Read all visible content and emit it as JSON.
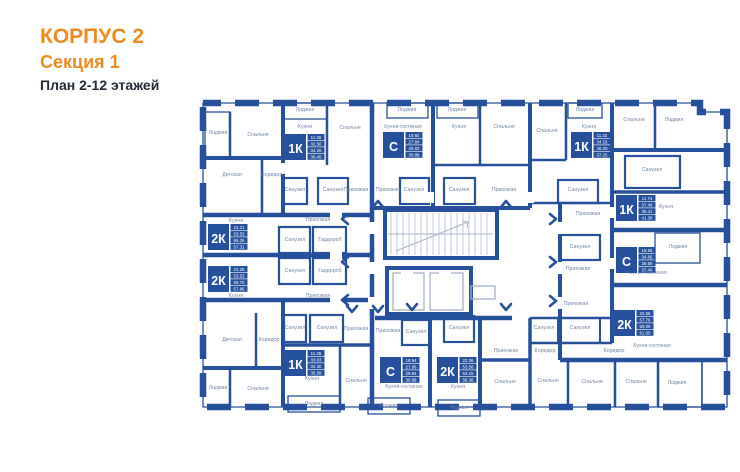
{
  "header": {
    "building": "КОРПУС 2",
    "section": "Секция 1",
    "floors": "План 2-12 этажей"
  },
  "colors": {
    "accent": "#ee8b1e",
    "wall": "#25519c",
    "room_label": "#7487a8",
    "title_dark": "#222b38",
    "stair_line": "#a7b4cd"
  },
  "plan": {
    "rooms": [
      {
        "label": "Лоджия",
        "x": 218,
        "y": 134
      },
      {
        "label": "Спальня",
        "x": 258,
        "y": 136
      },
      {
        "label": "Лоджия",
        "x": 305,
        "y": 111
      },
      {
        "label": "Кухня",
        "x": 305,
        "y": 128
      },
      {
        "label": "Спальня",
        "x": 350,
        "y": 129
      },
      {
        "label": "Лоджия",
        "x": 407,
        "y": 111
      },
      {
        "label": "Кухня-гостиная",
        "x": 403,
        "y": 128
      },
      {
        "label": "Лоджия",
        "x": 457,
        "y": 111
      },
      {
        "label": "Кухня",
        "x": 459,
        "y": 128
      },
      {
        "label": "Спальня",
        "x": 504,
        "y": 128
      },
      {
        "label": "Спальня",
        "x": 547,
        "y": 132
      },
      {
        "label": "Лоджия",
        "x": 585,
        "y": 111
      },
      {
        "label": "Кухня",
        "x": 589,
        "y": 128
      },
      {
        "label": "Спальня",
        "x": 634,
        "y": 121
      },
      {
        "label": "Лоджия",
        "x": 674,
        "y": 121
      },
      {
        "label": "Детская",
        "x": 232,
        "y": 176
      },
      {
        "label": "Коридор",
        "x": 272,
        "y": 176
      },
      {
        "label": "Санузел",
        "x": 295,
        "y": 191
      },
      {
        "label": "Санузел",
        "x": 333,
        "y": 191
      },
      {
        "label": "Прихожая",
        "x": 356,
        "y": 191
      },
      {
        "label": "Прихожая",
        "x": 388,
        "y": 191
      },
      {
        "label": "Санузел",
        "x": 414,
        "y": 191
      },
      {
        "label": "Санузел",
        "x": 459,
        "y": 191
      },
      {
        "label": "Прихожая",
        "x": 504,
        "y": 191
      },
      {
        "label": "Санузел",
        "x": 578,
        "y": 191
      },
      {
        "label": "Санузел",
        "x": 652,
        "y": 171
      },
      {
        "label": "Прихожая",
        "x": 588,
        "y": 215
      },
      {
        "label": "Кухня",
        "x": 666,
        "y": 208
      },
      {
        "label": "Кухня",
        "x": 236,
        "y": 222
      },
      {
        "label": "Прихожая",
        "x": 318,
        "y": 221
      },
      {
        "label": "Санузел",
        "x": 295,
        "y": 241
      },
      {
        "label": "Гардероб",
        "x": 330,
        "y": 241
      },
      {
        "label": "Санузел",
        "x": 295,
        "y": 272
      },
      {
        "label": "Гардероб",
        "x": 330,
        "y": 272
      },
      {
        "label": "Кухня",
        "x": 236,
        "y": 297
      },
      {
        "label": "Прихожая",
        "x": 318,
        "y": 297
      },
      {
        "label": "Санузел",
        "x": 580,
        "y": 248
      },
      {
        "label": "Прихожая",
        "x": 578,
        "y": 270
      },
      {
        "label": "Лоджия",
        "x": 678,
        "y": 248
      },
      {
        "label": "Кухня-гостиная",
        "x": 648,
        "y": 274
      },
      {
        "label": "Прихожая",
        "x": 576,
        "y": 305
      },
      {
        "label": "Санузел",
        "x": 544,
        "y": 329
      },
      {
        "label": "Санузел",
        "x": 580,
        "y": 329
      },
      {
        "label": "Коридор",
        "x": 545,
        "y": 352
      },
      {
        "label": "Коридор",
        "x": 614,
        "y": 352
      },
      {
        "label": "Кухня-гостиная",
        "x": 652,
        "y": 347
      },
      {
        "label": "Детская",
        "x": 232,
        "y": 341
      },
      {
        "label": "Коридор",
        "x": 269,
        "y": 341
      },
      {
        "label": "Санузел",
        "x": 295,
        "y": 329
      },
      {
        "label": "Санузел",
        "x": 327,
        "y": 329
      },
      {
        "label": "Прихожая",
        "x": 356,
        "y": 330
      },
      {
        "label": "Прихожая",
        "x": 388,
        "y": 332
      },
      {
        "label": "Санузел",
        "x": 416,
        "y": 333
      },
      {
        "label": "Санузел",
        "x": 459,
        "y": 329
      },
      {
        "label": "Прихожая",
        "x": 506,
        "y": 352
      },
      {
        "label": "Лоджия",
        "x": 218,
        "y": 389
      },
      {
        "label": "Спальня",
        "x": 258,
        "y": 390
      },
      {
        "label": "Кухня",
        "x": 312,
        "y": 380
      },
      {
        "label": "Спальня",
        "x": 356,
        "y": 382
      },
      {
        "label": "Кухня-гостиная",
        "x": 404,
        "y": 388
      },
      {
        "label": "Кухня",
        "x": 458,
        "y": 388
      },
      {
        "label": "Лоджия",
        "x": 314,
        "y": 405
      },
      {
        "label": "Лоджия",
        "x": 389,
        "y": 407
      },
      {
        "label": "Лоджия",
        "x": 459,
        "y": 409
      },
      {
        "label": "Спальня",
        "x": 505,
        "y": 383
      },
      {
        "label": "Спальня",
        "x": 548,
        "y": 382
      },
      {
        "label": "Спальня",
        "x": 592,
        "y": 383
      },
      {
        "label": "Спальня",
        "x": 636,
        "y": 383
      },
      {
        "label": "Лоджия",
        "x": 677,
        "y": 384
      }
    ],
    "apartments": [
      {
        "type": "1К",
        "areas": [
          "11.36",
          "32.50",
          "34.26",
          "36.45"
        ],
        "x": 285,
        "y": 134
      },
      {
        "type": "С",
        "areas": [
          "18.92",
          "27.84",
          "29.83",
          "30.88"
        ],
        "x": 383,
        "y": 132
      },
      {
        "type": "1К",
        "areas": [
          "11.32",
          "34.15",
          "36.20",
          "37.25"
        ],
        "x": 571,
        "y": 132
      },
      {
        "type": "1К",
        "areas": [
          "11.74",
          "37.46",
          "39.41",
          "41.36"
        ],
        "x": 616,
        "y": 195
      },
      {
        "type": "С",
        "areas": [
          "18.56",
          "34.66",
          "36.65",
          "37.40"
        ],
        "x": 616,
        "y": 247
      },
      {
        "type": "2К",
        "areas": [
          "22.56",
          "57.76",
          "59.05",
          "61.00"
        ],
        "x": 614,
        "y": 310
      },
      {
        "type": "2К",
        "areas": [
          "22.21",
          "53.53",
          "55.26",
          "57.31"
        ],
        "x": 208,
        "y": 224
      },
      {
        "type": "2К",
        "areas": [
          "22.26",
          "53.53",
          "55.70",
          "57.86"
        ],
        "x": 208,
        "y": 266
      },
      {
        "type": "1К",
        "areas": [
          "11.36",
          "33.03",
          "34.30",
          "35.58"
        ],
        "x": 285,
        "y": 350
      },
      {
        "type": "С",
        "areas": [
          "18.94",
          "27.86",
          "29.84",
          "30.88"
        ],
        "x": 380,
        "y": 357
      },
      {
        "type": "2К",
        "areas": [
          "22.36",
          "53.56",
          "54.15",
          "56.36"
        ],
        "x": 437,
        "y": 357
      }
    ],
    "entrance_arrows": [
      {
        "x": 378,
        "y": 204,
        "dir": "up"
      },
      {
        "x": 506,
        "y": 204,
        "dir": "up"
      },
      {
        "x": 352,
        "y": 309,
        "dir": "down"
      },
      {
        "x": 378,
        "y": 309,
        "dir": "down"
      },
      {
        "x": 412,
        "y": 307,
        "dir": "down"
      },
      {
        "x": 506,
        "y": 307,
        "dir": "down"
      },
      {
        "x": 345,
        "y": 219,
        "dir": "left"
      },
      {
        "x": 345,
        "y": 262,
        "dir": "left"
      },
      {
        "x": 345,
        "y": 300,
        "dir": "left"
      },
      {
        "x": 553,
        "y": 219,
        "dir": "right"
      },
      {
        "x": 553,
        "y": 262,
        "dir": "right"
      },
      {
        "x": 553,
        "y": 301,
        "dir": "right"
      }
    ]
  }
}
